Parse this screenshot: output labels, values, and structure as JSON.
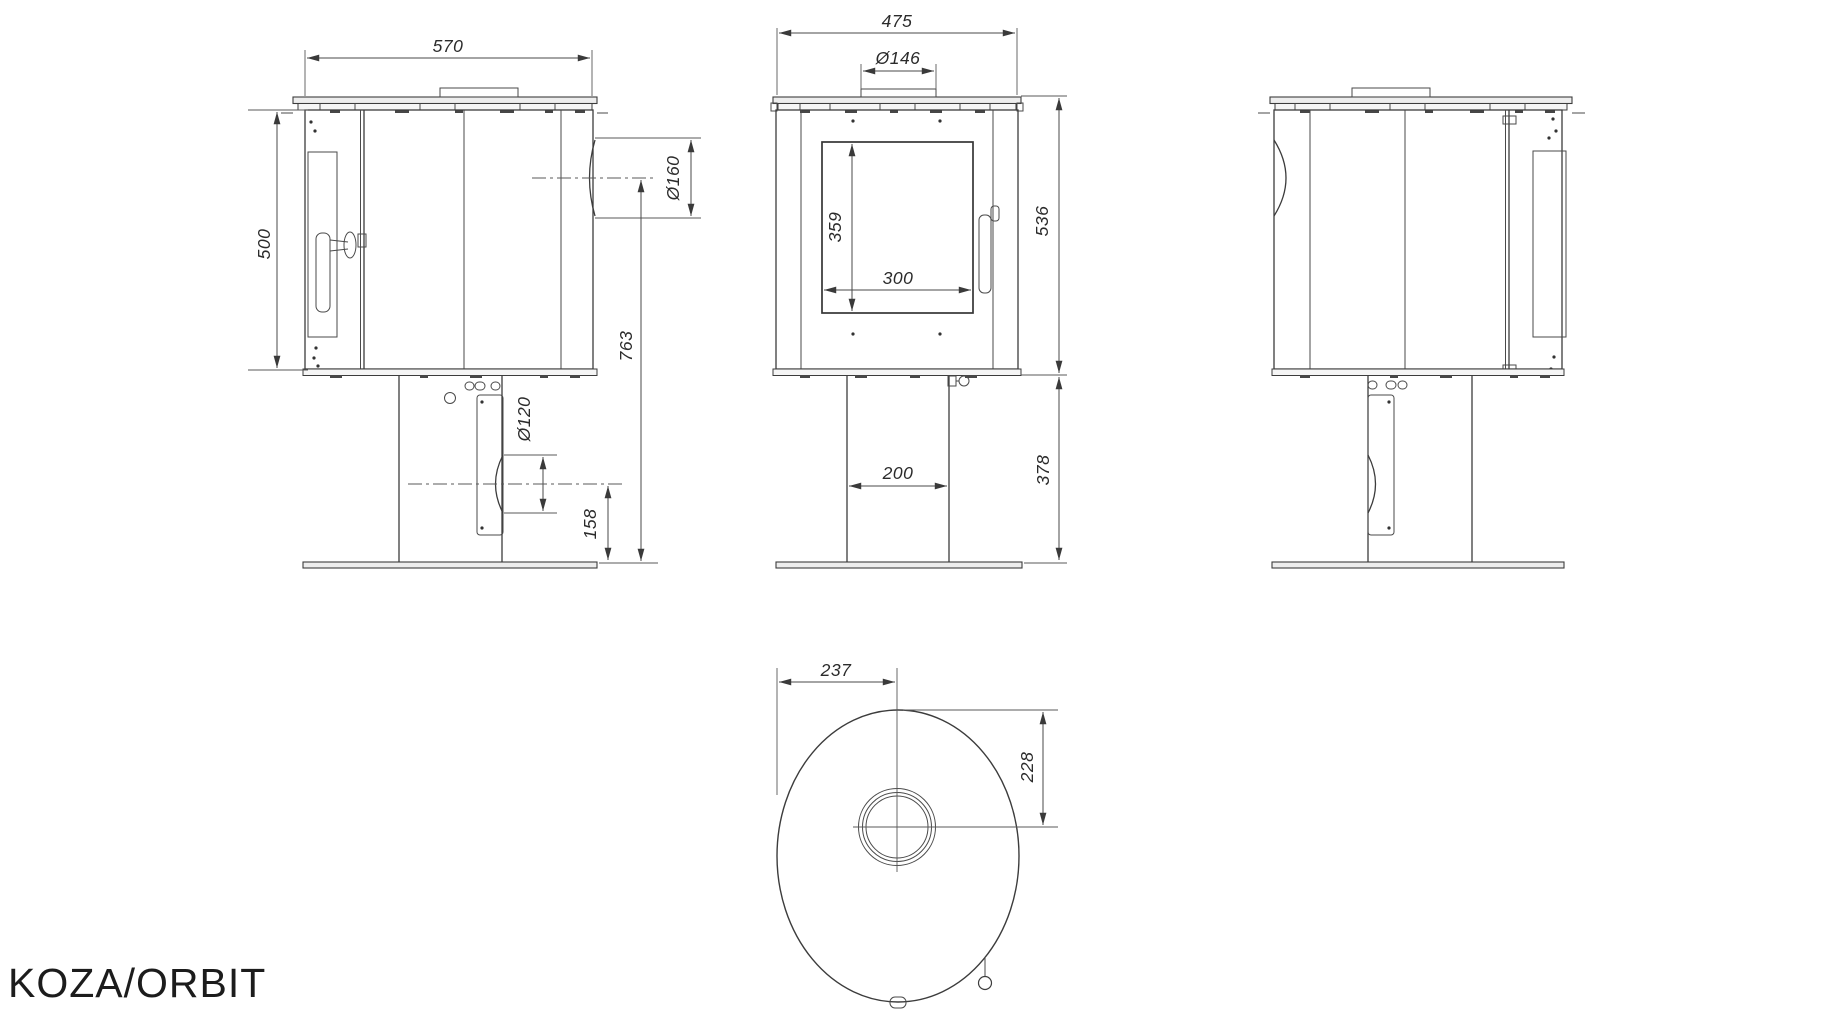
{
  "product_name": "KOZA/ORBIT",
  "dimensions": {
    "side": {
      "width": "570",
      "height": "500",
      "flue_diameter": "Ø160",
      "flue_center_height": "763",
      "outlet_diameter": "Ø120",
      "outlet_center_height": "158"
    },
    "front": {
      "width": "475",
      "collar_diameter": "Ø146",
      "glass_height": "359",
      "glass_width": "300",
      "body_height": "536",
      "base_height": "378",
      "pedestal_width": "200"
    },
    "top": {
      "edge_to_center": "237",
      "flue_center_offset": "228"
    }
  }
}
